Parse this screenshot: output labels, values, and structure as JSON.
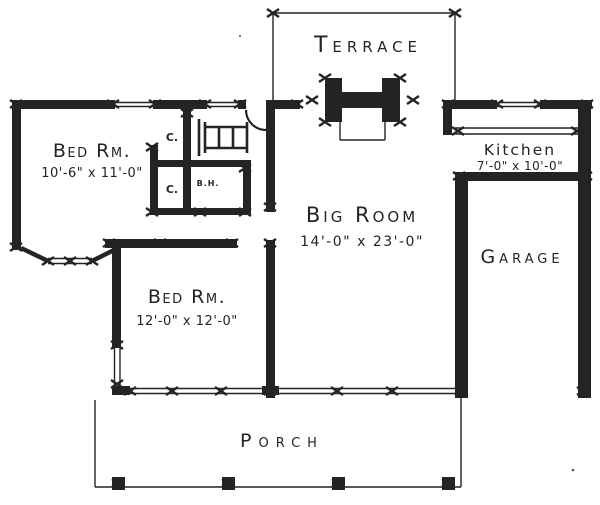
{
  "drawing": {
    "ink_color": "#242424",
    "paper_color": "#ffffff"
  },
  "rooms": {
    "terrace": {
      "label": "Terrace"
    },
    "big_room": {
      "label": "Big Room",
      "dims": "14'-0\" x 23'-0\""
    },
    "bedroom1": {
      "label": "Bed Rm.",
      "dims": "10'-6\" x 11'-0\""
    },
    "bedroom2": {
      "label": "Bed Rm.",
      "dims": "12'-0\" x 12'-0\""
    },
    "kitchen": {
      "label": "Kitchen",
      "dims": "7'-0\" x 10'-0\""
    },
    "garage": {
      "label": "Garage"
    },
    "porch": {
      "label": "Porch"
    },
    "bath": {
      "label": "B.H."
    },
    "closet_upper": {
      "label": "C."
    },
    "closet_lower": {
      "label": "C."
    }
  },
  "features": {
    "fireplace": "fireplace-symbol",
    "attic_ladder": "ladder-stairs-symbol",
    "bay_window": "bay-window-symbol",
    "entry_door": "door-swing-arc"
  }
}
